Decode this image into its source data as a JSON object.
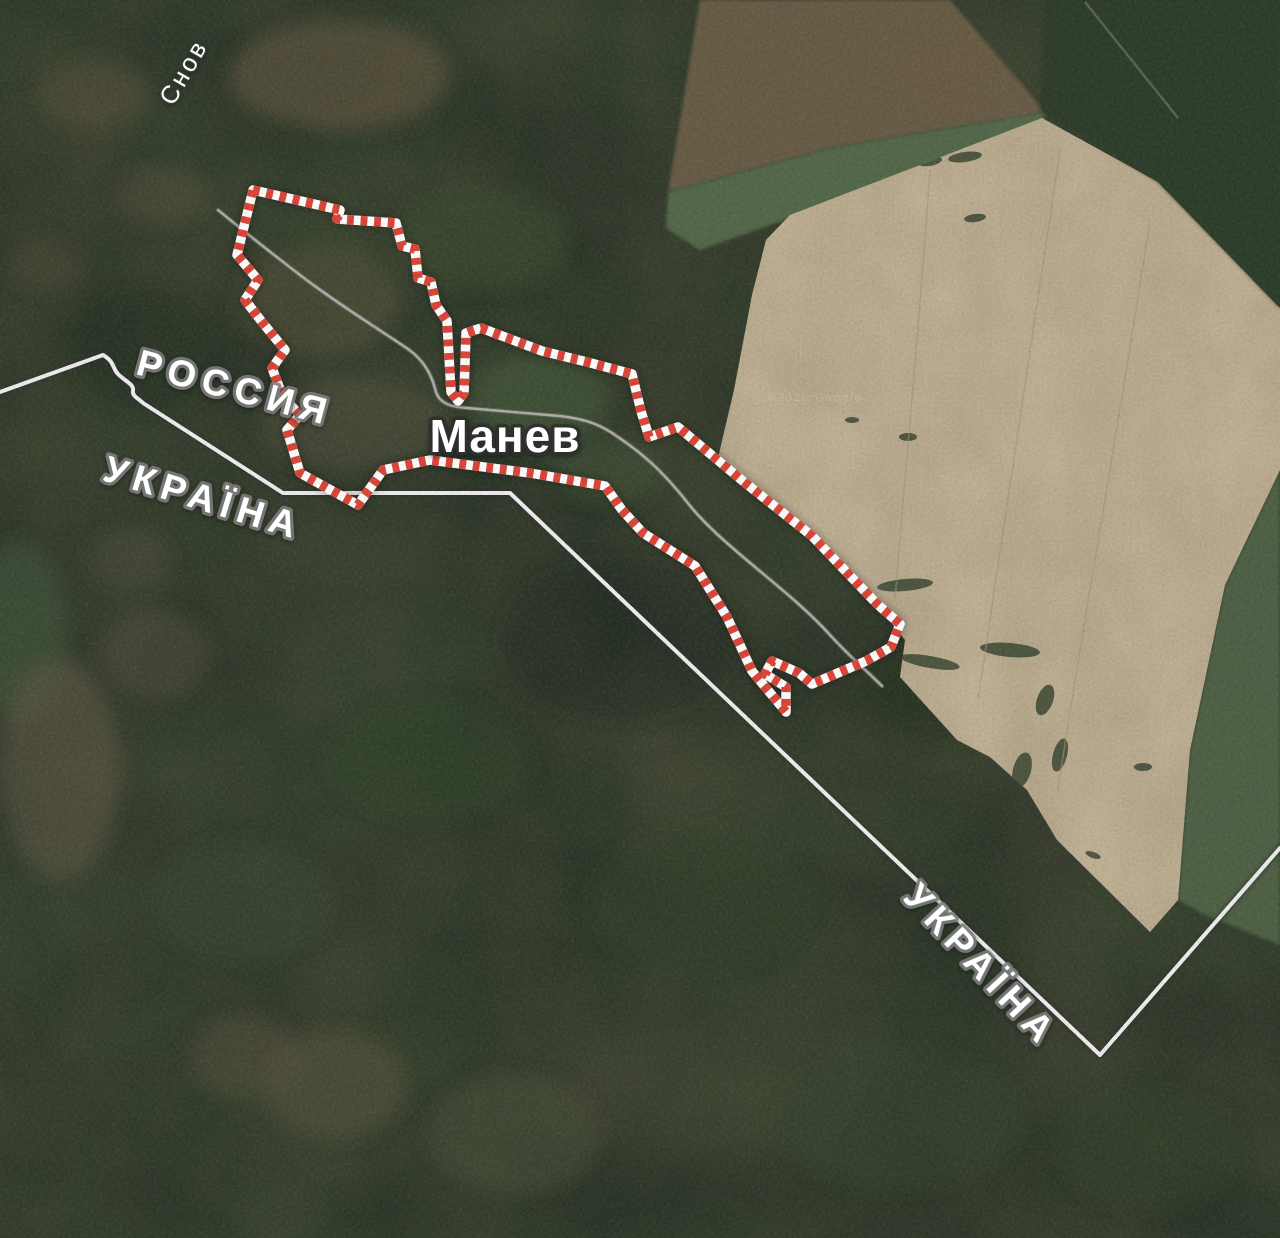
{
  "map": {
    "labels": {
      "river": "Снов",
      "country_russia": "РОССИЯ",
      "country_ukraine_left": "УКРАЇНА",
      "country_ukraine_bottom": "УКРАЇНА",
      "settlement": "Манев",
      "watermark": "©2025 Google"
    },
    "colors": {
      "forest_dark": "#2b3628",
      "field_tan": "#b7a88c",
      "grass_green": "#52654a",
      "road_gray": "#b3b3ab",
      "border_line": "#efefef",
      "selection_red": "#dc4437",
      "selection_white": "#ffffff",
      "label_white": "#ffffff"
    }
  }
}
